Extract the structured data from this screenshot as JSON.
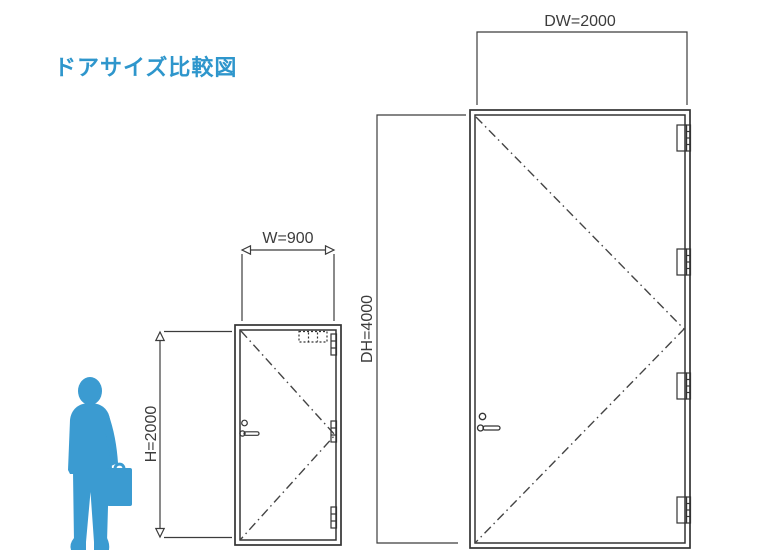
{
  "title": "ドアサイズ比較図",
  "small_door": {
    "width_label": "W=900",
    "height_label": "H=2000"
  },
  "large_door": {
    "width_label": "DW=2000",
    "height_label": "DH=4000"
  },
  "icons": {
    "person": "person-silhouette-with-briefcase-icon"
  },
  "colors": {
    "title_text": "#2E96CC",
    "silhouette_blue": "#3B9BD1",
    "line_color": "#333333",
    "background": "#FFFFFF"
  }
}
